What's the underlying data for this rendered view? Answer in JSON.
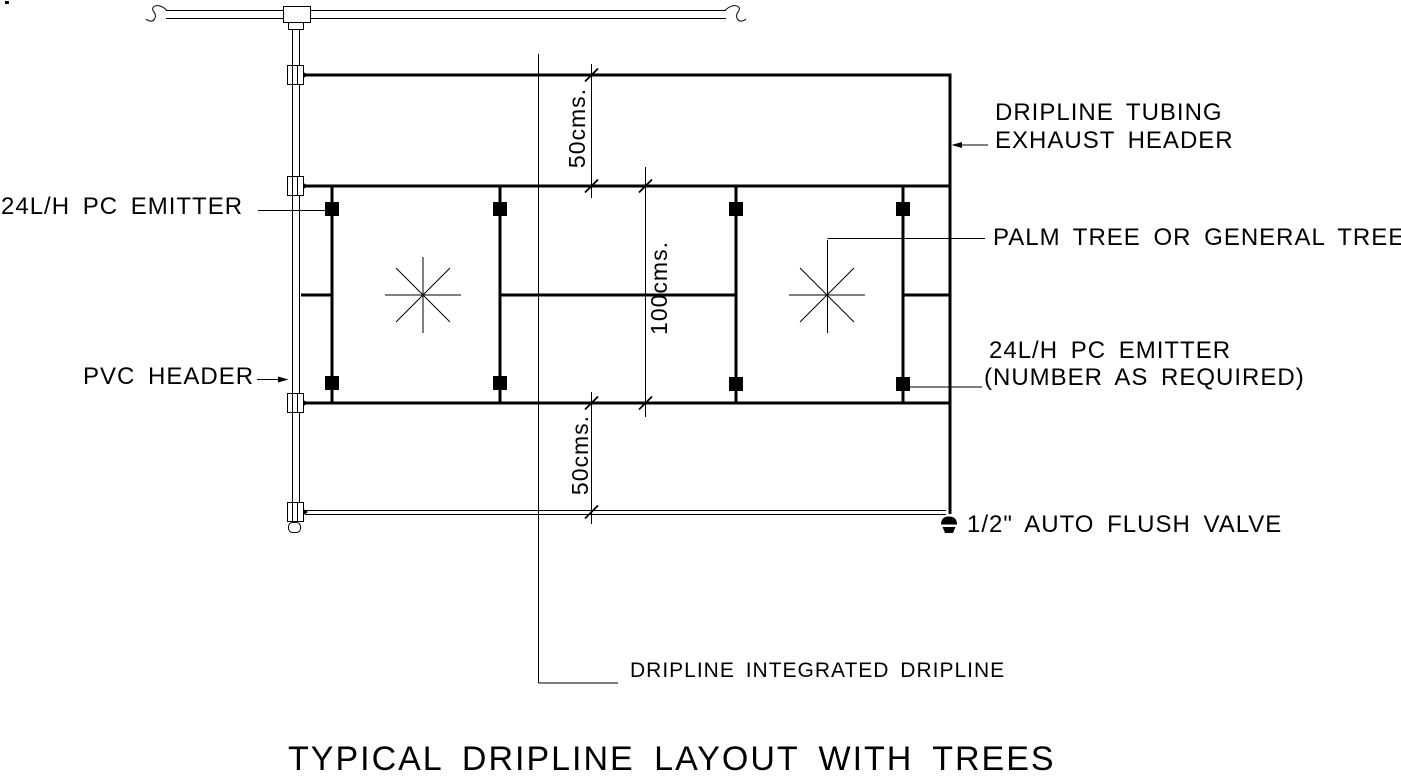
{
  "diagram": {
    "title": "TYPICAL DRIPLINE LAYOUT WITH TREES",
    "labels": {
      "emitter_left": "24L/H PC EMITTER",
      "pvc_header": "PVC HEADER",
      "exhaust_header_line1": "DRIPLINE TUBING",
      "exhaust_header_line2": "EXHAUST HEADER",
      "palm_tree": "PALM TREE OR GENERAL TREE",
      "emitter_right_line1": "24L/H PC EMITTER",
      "emitter_right_line2": "(NUMBER AS REQUIRED)",
      "flush_valve": "1/2\" AUTO FLUSH VALVE",
      "dripline_integrated": "DRIPLINE INTEGRATED DRIPLINE"
    },
    "dimensions": {
      "top": "50cms.",
      "middle": "100cms.",
      "bottom": "50cms."
    },
    "colors": {
      "line": "#000000",
      "background": "#ffffff"
    }
  }
}
